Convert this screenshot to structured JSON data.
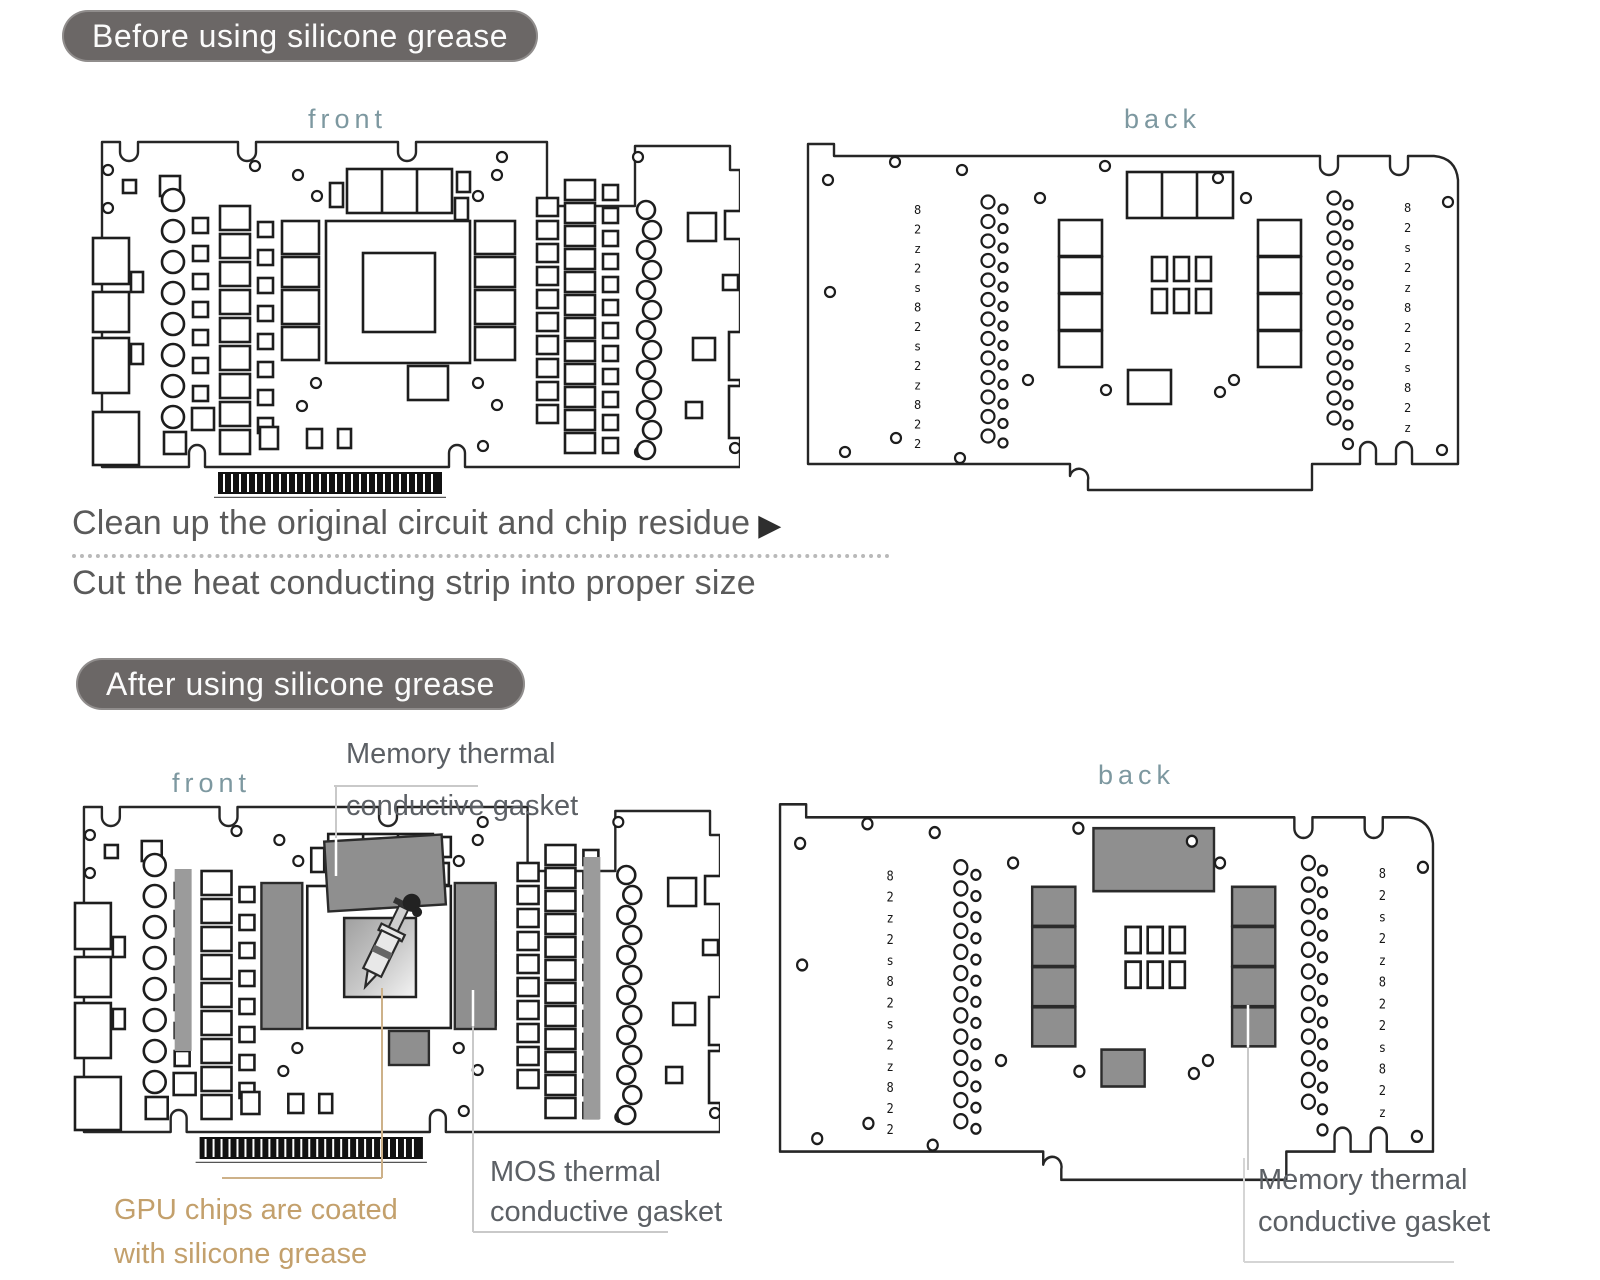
{
  "colors": {
    "badge_bg": "#6b6766",
    "badge_text": "#fbfbfb",
    "view_label": "#7d98a0",
    "caption": "#5a5a5a",
    "tan": "#c3a06c",
    "callout": "#5c6065",
    "gasket": "#8f8f8f",
    "strip": "#9b9b9b",
    "leader_light": "#c9c9c9",
    "leader_tan": "#cdb189"
  },
  "before": {
    "badge": "Before using silicone grease",
    "front_label": "front",
    "back_label": "back"
  },
  "steps": {
    "line1": "Clean up the original circuit and chip residue",
    "arrow": "▶",
    "line2": "Cut the heat conducting strip into proper size"
  },
  "after": {
    "badge": "After using silicone grease",
    "front_label": "front",
    "back_label": "back",
    "callout_memory_front": {
      "line1": "Memory thermal",
      "line2": "conductive gasket"
    },
    "callout_gpu": {
      "line1": "GPU chips are coated",
      "line2": "with silicone grease"
    },
    "callout_mos": {
      "line1": "MOS thermal",
      "line2": "conductive gasket"
    },
    "callout_memory_back": {
      "line1": "Memory thermal",
      "line2": "conductive gasket"
    }
  },
  "silkscreen": {
    "glyphs": [
      "8",
      "2",
      "z",
      "2",
      "s",
      "8",
      "2",
      "s",
      "2",
      "z",
      "8",
      "2",
      "2",
      "s"
    ]
  }
}
